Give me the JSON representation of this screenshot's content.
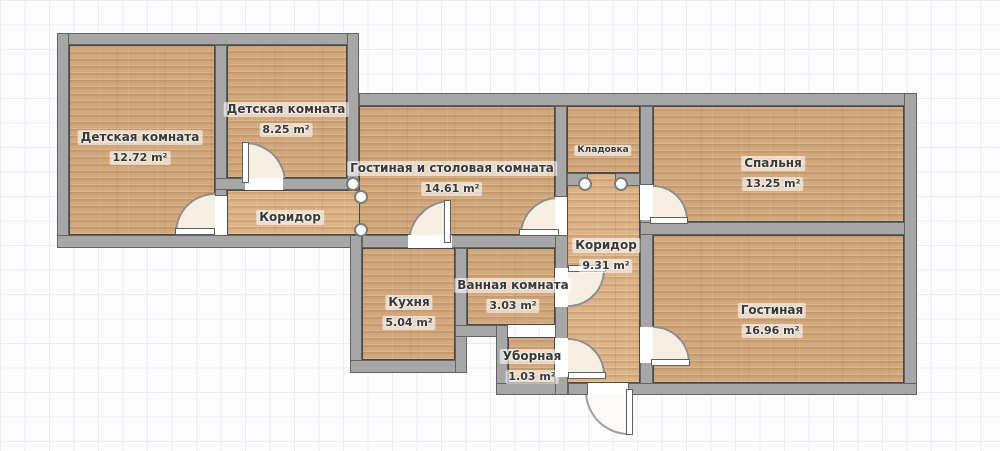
{
  "palette": {
    "wall": "#a7a7a7",
    "wall_outline": "#4c4c4c",
    "floor_wood": "#d3a87c",
    "door_arc_fill": "#f6eee1",
    "grid_line": "#ebebf3",
    "label_text": "#383838",
    "label_halo": "#ffffff"
  },
  "units_note": "m²",
  "rooms": [
    {
      "id": "children-room-large",
      "name": "Детская комната",
      "area": "12.72 m²"
    },
    {
      "id": "children-room-small",
      "name": "Детская комната",
      "area": "8.25 m²"
    },
    {
      "id": "living-dining-room",
      "name": "Гостиная и столовая комната",
      "area": "14.61 m²"
    },
    {
      "id": "corridor-left",
      "name": "Коридор",
      "area": ""
    },
    {
      "id": "pantry",
      "name": "Кладовка",
      "area": ""
    },
    {
      "id": "bedroom",
      "name": "Спальня",
      "area": "13.25 m²"
    },
    {
      "id": "corridor-main",
      "name": "Коридор",
      "area": "9.31 m²"
    },
    {
      "id": "kitchen",
      "name": "Кухня",
      "area": "5.04 m²"
    },
    {
      "id": "bathroom",
      "name": "Ванная комната",
      "area": "3.03 m²"
    },
    {
      "id": "toilet",
      "name": "Уборная",
      "area": "1.03 m²"
    },
    {
      "id": "living-room",
      "name": "Гостиная",
      "area": "16.96 m²"
    }
  ]
}
